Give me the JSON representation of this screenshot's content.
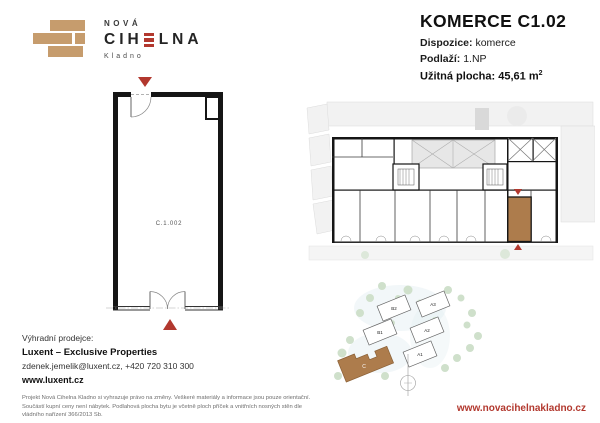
{
  "logo": {
    "top": "NOVÁ",
    "main_left": "CIH",
    "main_right": "LNA",
    "city": "Kladno"
  },
  "header": {
    "title": "KOMERCE C1.02",
    "fields": [
      {
        "label": "Dispozice:",
        "value": "komerce"
      },
      {
        "label": "Podlaží:",
        "value": "1.NP"
      }
    ],
    "area": {
      "label": "Užitná plocha:",
      "value": "45,61 m",
      "sup": "2"
    }
  },
  "floor_plan": {
    "unit_label": "C.1.002"
  },
  "site_plan": {
    "buildings": [
      "B2",
      "B1",
      "A3",
      "A2",
      "A1"
    ],
    "highlighted_building": "C"
  },
  "seller": {
    "heading": "Výhradní prodejce:",
    "name": "Luxent – Exclusive Properties",
    "contact": "zdenek.jemelik@luxent.cz, +420 720 310 300",
    "web": "www.luxent.cz"
  },
  "disclaimer": "Projekt Nová Cihelna Kladno si vyhrazuje právo na změny. Veškeré materiály a informace jsou pouze orientační. Součástí kupní ceny není nábytek. Podlahová plocha bytu je včetně ploch příček a vnitřních nosných stěn dle vládního nařízení 366/2013 Sb.",
  "footer": {
    "website": "www.novacihelnakladno.cz"
  },
  "colors": {
    "accent_red": "#b2382e",
    "brick_tan": "#c69c6d",
    "unit_brown": "#ad7c4c",
    "tree_green": "#cfe0cb"
  }
}
